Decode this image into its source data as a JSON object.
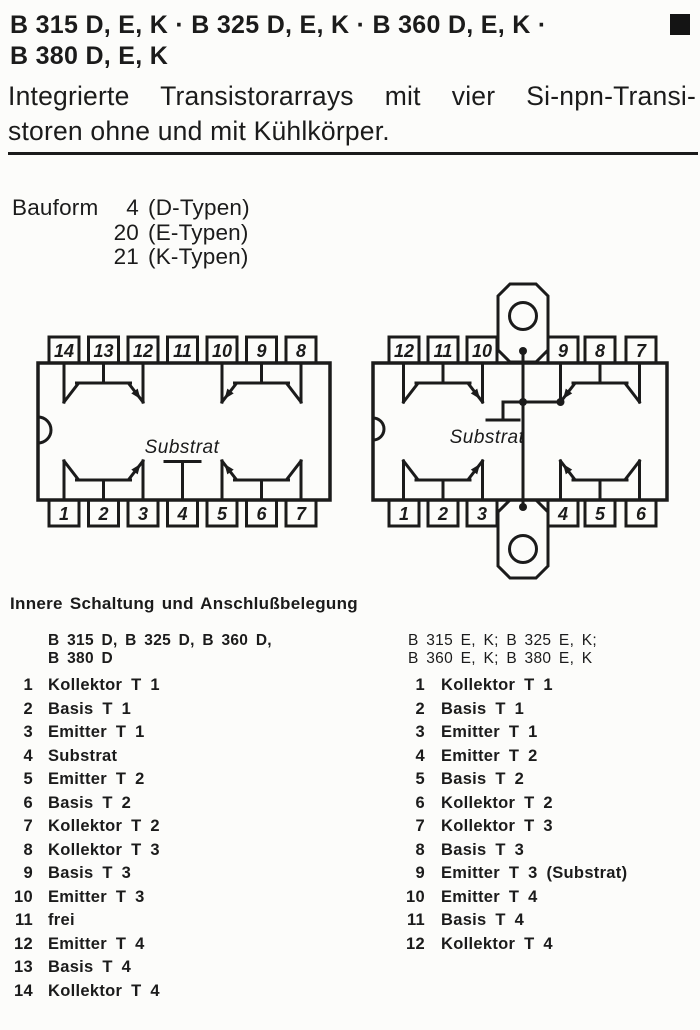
{
  "header": {
    "title_line1": "B 315 D, E, K · B 325 D, E, K · B 360 D, E, K ·",
    "title_line2": "B 380 D, E, K",
    "subtitle_line1": "Integrierte Transistorarrays mit vier Si-npn-Transi-",
    "subtitle_line2": "storen ohne und mit Kühlkörper."
  },
  "bauform": {
    "label": "Bauform",
    "rows": [
      {
        "num": "4",
        "text": "(D-Typen)"
      },
      {
        "num": "20",
        "text": "(E-Typen)"
      },
      {
        "num": "21",
        "text": "(K-Typen)"
      }
    ]
  },
  "diagrams": {
    "left": {
      "top_pins": [
        "14",
        "13",
        "12",
        "11",
        "10",
        "9",
        "8"
      ],
      "bottom_pins": [
        "1",
        "2",
        "3",
        "4",
        "5",
        "6",
        "7"
      ],
      "substrate_label": "Substrat"
    },
    "right": {
      "top_pins": [
        "12",
        "11",
        "10",
        "9",
        "8",
        "7"
      ],
      "bottom_pins": [
        "1",
        "2",
        "3",
        "4",
        "5",
        "6"
      ],
      "substrate_label": "Substrat"
    }
  },
  "pinout": {
    "heading": "Innere Schaltung und Anschlußbelegung",
    "left": {
      "header_line1": "B 315 D, B 325 D, B 360 D,",
      "header_line2": "B 380 D",
      "rows": [
        {
          "n": "1",
          "label": "Kollektor T 1"
        },
        {
          "n": "2",
          "label": "Basis T 1"
        },
        {
          "n": "3",
          "label": "Emitter T 1"
        },
        {
          "n": "4",
          "label": "Substrat"
        },
        {
          "n": "5",
          "label": "Emitter T 2"
        },
        {
          "n": "6",
          "label": "Basis T 2"
        },
        {
          "n": "7",
          "label": "Kollektor T 2"
        },
        {
          "n": "8",
          "label": "Kollektor T 3"
        },
        {
          "n": "9",
          "label": "Basis T 3"
        },
        {
          "n": "10",
          "label": "Emitter T 3"
        },
        {
          "n": "11",
          "label": "frei"
        },
        {
          "n": "12",
          "label": "Emitter T 4"
        },
        {
          "n": "13",
          "label": "Basis T 4"
        },
        {
          "n": "14",
          "label": "Kollektor T 4"
        }
      ]
    },
    "right": {
      "header_line1": "B 315 E, K; B 325 E, K;",
      "header_line2": "B 360 E, K; B 380 E, K",
      "rows": [
        {
          "n": "1",
          "label": "Kollektor T 1"
        },
        {
          "n": "2",
          "label": "Basis T 1"
        },
        {
          "n": "3",
          "label": "Emitter T 1"
        },
        {
          "n": "4",
          "label": "Emitter T 2"
        },
        {
          "n": "5",
          "label": "Basis T 2"
        },
        {
          "n": "6",
          "label": "Kollektor T 2"
        },
        {
          "n": "7",
          "label": "Kollektor T 3"
        },
        {
          "n": "8",
          "label": "Basis T 3"
        },
        {
          "n": "9",
          "label": "Emitter T 3 (Substrat)"
        },
        {
          "n": "10",
          "label": "Emitter T 4"
        },
        {
          "n": "11",
          "label": "Basis T 4"
        },
        {
          "n": "12",
          "label": "Kollektor T 4"
        }
      ]
    }
  },
  "colors": {
    "ink": "#1b1b1b",
    "paper": "#fcfcfa"
  }
}
